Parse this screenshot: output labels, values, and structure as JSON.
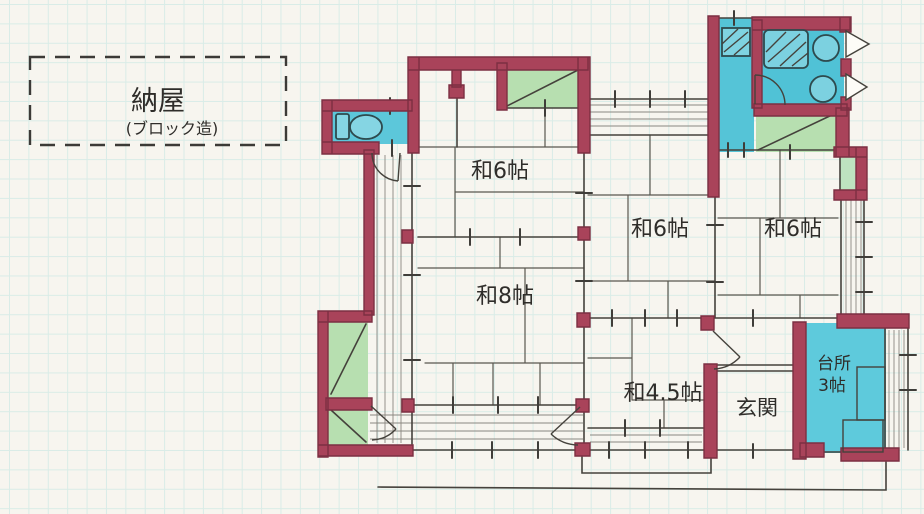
{
  "page": {
    "description": "Hand-drawn Japanese house floor plan sketch on graph paper"
  },
  "annex": {
    "label": "納屋",
    "note": "(ブロック造)"
  },
  "rooms": {
    "tatami6_north": {
      "label": "和6帖"
    },
    "tatami6_center": {
      "label": "和6帖"
    },
    "tatami6_east": {
      "label": "和6帖"
    },
    "tatami8": {
      "label": "和8帖"
    },
    "tatami45": {
      "label": "和4.5帖"
    },
    "entrance": {
      "label": "玄関"
    },
    "kitchen": {
      "line1": "台所",
      "line2": "3帖"
    }
  },
  "palette": {
    "paper": "#f7f5ef",
    "grid_line": "#d9ece7",
    "ink": "#45423c",
    "wall_red": "#a9435a",
    "wall_red_dark": "#7c2f42",
    "water_blue": "#58c6d8",
    "closet_green": "#b7dfb0"
  }
}
